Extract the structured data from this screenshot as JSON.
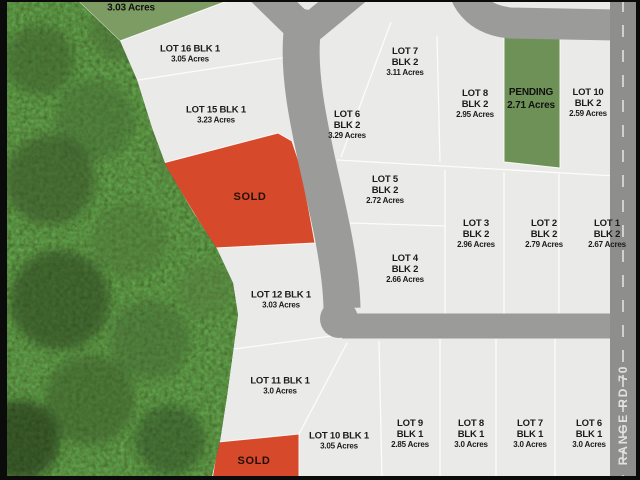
{
  "map": {
    "kind": "subdivision-plat-map",
    "road_label": "RANGE RD 70",
    "colors": {
      "sold": "#d64a2b",
      "pending": "#6e9157",
      "pending_light": "#7d9c63",
      "road": "#9b9b99",
      "road_secondary": "#8e8e8c",
      "lot_fill": "#eaeae8",
      "boundary_line": "#ffffff",
      "forest_base": "#1f3317",
      "label_text": "#1b1b1b",
      "edge_black": "#0b0b0b"
    }
  },
  "lots": [
    {
      "title": "",
      "subtitle": "",
      "acres": "3.03 Acres",
      "status": "pending"
    },
    {
      "title": "LOT 16 BLK 1",
      "subtitle": "",
      "acres": "3.05 Acres",
      "status": "available"
    },
    {
      "title": "LOT 15 BLK 1",
      "subtitle": "",
      "acres": "3.23 Acres",
      "status": "available"
    },
    {
      "title": "SOLD",
      "subtitle": "",
      "acres": "",
      "status": "sold"
    },
    {
      "title": "LOT 12 BLK 1",
      "subtitle": "",
      "acres": "3.03 Acres",
      "status": "available"
    },
    {
      "title": "LOT 11 BLK 1",
      "subtitle": "",
      "acres": "3.0 Acres",
      "status": "available"
    },
    {
      "title": "SOLD",
      "subtitle": "",
      "acres": "",
      "status": "sold"
    },
    {
      "title": "LOT 7",
      "subtitle": "BLK 2",
      "acres": "3.11 Acres",
      "status": "available"
    },
    {
      "title": "LOT 8",
      "subtitle": "BLK 2",
      "acres": "2.95 Acres",
      "status": "available"
    },
    {
      "title": "PENDING",
      "subtitle": "",
      "acres": "2.71 Acres",
      "status": "pending"
    },
    {
      "title": "LOT 10",
      "subtitle": "BLK 2",
      "acres": "2.59 Acres",
      "status": "available"
    },
    {
      "title": "LOT 6",
      "subtitle": "BLK 2",
      "acres": "3.29 Acres",
      "status": "available"
    },
    {
      "title": "LOT 5",
      "subtitle": "BLK 2",
      "acres": "2.72 Acres",
      "status": "available"
    },
    {
      "title": "LOT 4",
      "subtitle": "BLK 2",
      "acres": "2.66 Acres",
      "status": "available"
    },
    {
      "title": "LOT 3",
      "subtitle": "BLK 2",
      "acres": "2.96 Acres",
      "status": "available"
    },
    {
      "title": "LOT 2",
      "subtitle": "BLK 2",
      "acres": "2.79 Acres",
      "status": "available"
    },
    {
      "title": "LOT 1",
      "subtitle": "BLK 2",
      "acres": "2.67 Acres",
      "status": "available"
    },
    {
      "title": "LOT 10 BLK 1",
      "subtitle": "",
      "acres": "3.05 Acres",
      "status": "available"
    },
    {
      "title": "LOT 9",
      "subtitle": "BLK 1",
      "acres": "2.85 Acres",
      "status": "available"
    },
    {
      "title": "LOT 8",
      "subtitle": "BLK 1",
      "acres": "3.0 Acres",
      "status": "available"
    },
    {
      "title": "LOT 7",
      "subtitle": "BLK 1",
      "acres": "3.0 Acres",
      "status": "available"
    },
    {
      "title": "LOT 6",
      "subtitle": "BLK 1",
      "acres": "3.0 Acres",
      "status": "available"
    }
  ]
}
